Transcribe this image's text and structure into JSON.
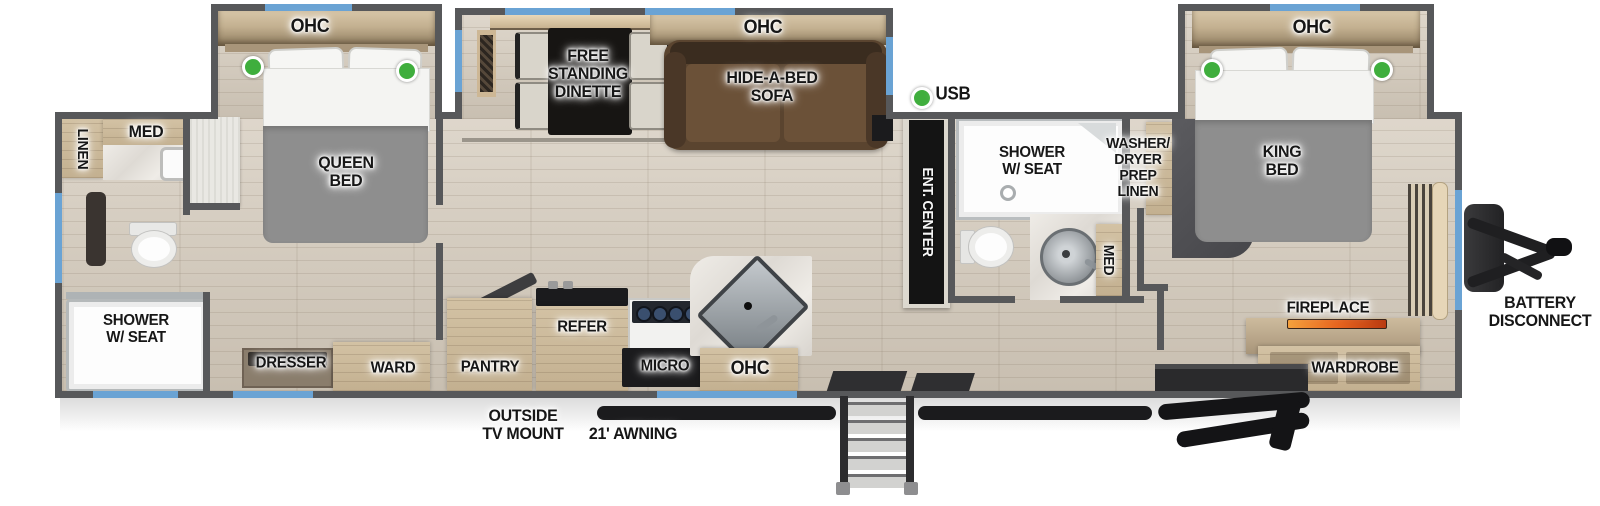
{
  "plan": {
    "type": "travel-trailer floor plan",
    "labels": {
      "linen_rear": "LINEN",
      "med_rear": "MED",
      "shower_rear": "SHOWER\nW/ SEAT",
      "queen_bed": "QUEEN\nBED",
      "ohc_queen": "OHC",
      "dresser": "DRESSER",
      "ward": "WARD",
      "dinette": "FREE\nSTANDING\nDINETTE",
      "ohc_dinette": "OHC",
      "sofa": "HIDE-A-BED\nSOFA",
      "usb": "USB",
      "ent_center": "ENT. CENTER",
      "pantry": "PANTRY",
      "refer": "REFER",
      "micro": "MICRO",
      "ohc_kitchen": "OHC",
      "outside_tv": "OUTSIDE\nTV MOUNT",
      "awning": "21' AWNING",
      "shower_mid": "SHOWER\nW/ SEAT",
      "med_mid": "MED",
      "washer_dryer": "WASHER/\nDRYER\nPREP\nLINEN",
      "king_bed": "KING\nBED",
      "ohc_king": "OHC",
      "fireplace": "FIREPLACE",
      "wardrobe": "WARDROBE",
      "battery": "BATTERY\nDISCONNECT"
    }
  },
  "colors": {
    "wall": "#57585a",
    "floor": "#d3c9ba",
    "win": "#6aa3d4",
    "green": "#3fae3d",
    "wood": "#c3b090",
    "wood2": "#d3c2a4",
    "wood3": "#8d7b5e",
    "marble": "#e9e6e1",
    "bed": "#8e8e8e",
    "bedsheet": "#f4f4f2",
    "sofa": "#5a442f",
    "sofa2": "#6b5138",
    "sofa3": "#3a2c1f",
    "dark": "#1b1b1d",
    "flame": "#e8651f",
    "steel": "#9aa0a4"
  }
}
